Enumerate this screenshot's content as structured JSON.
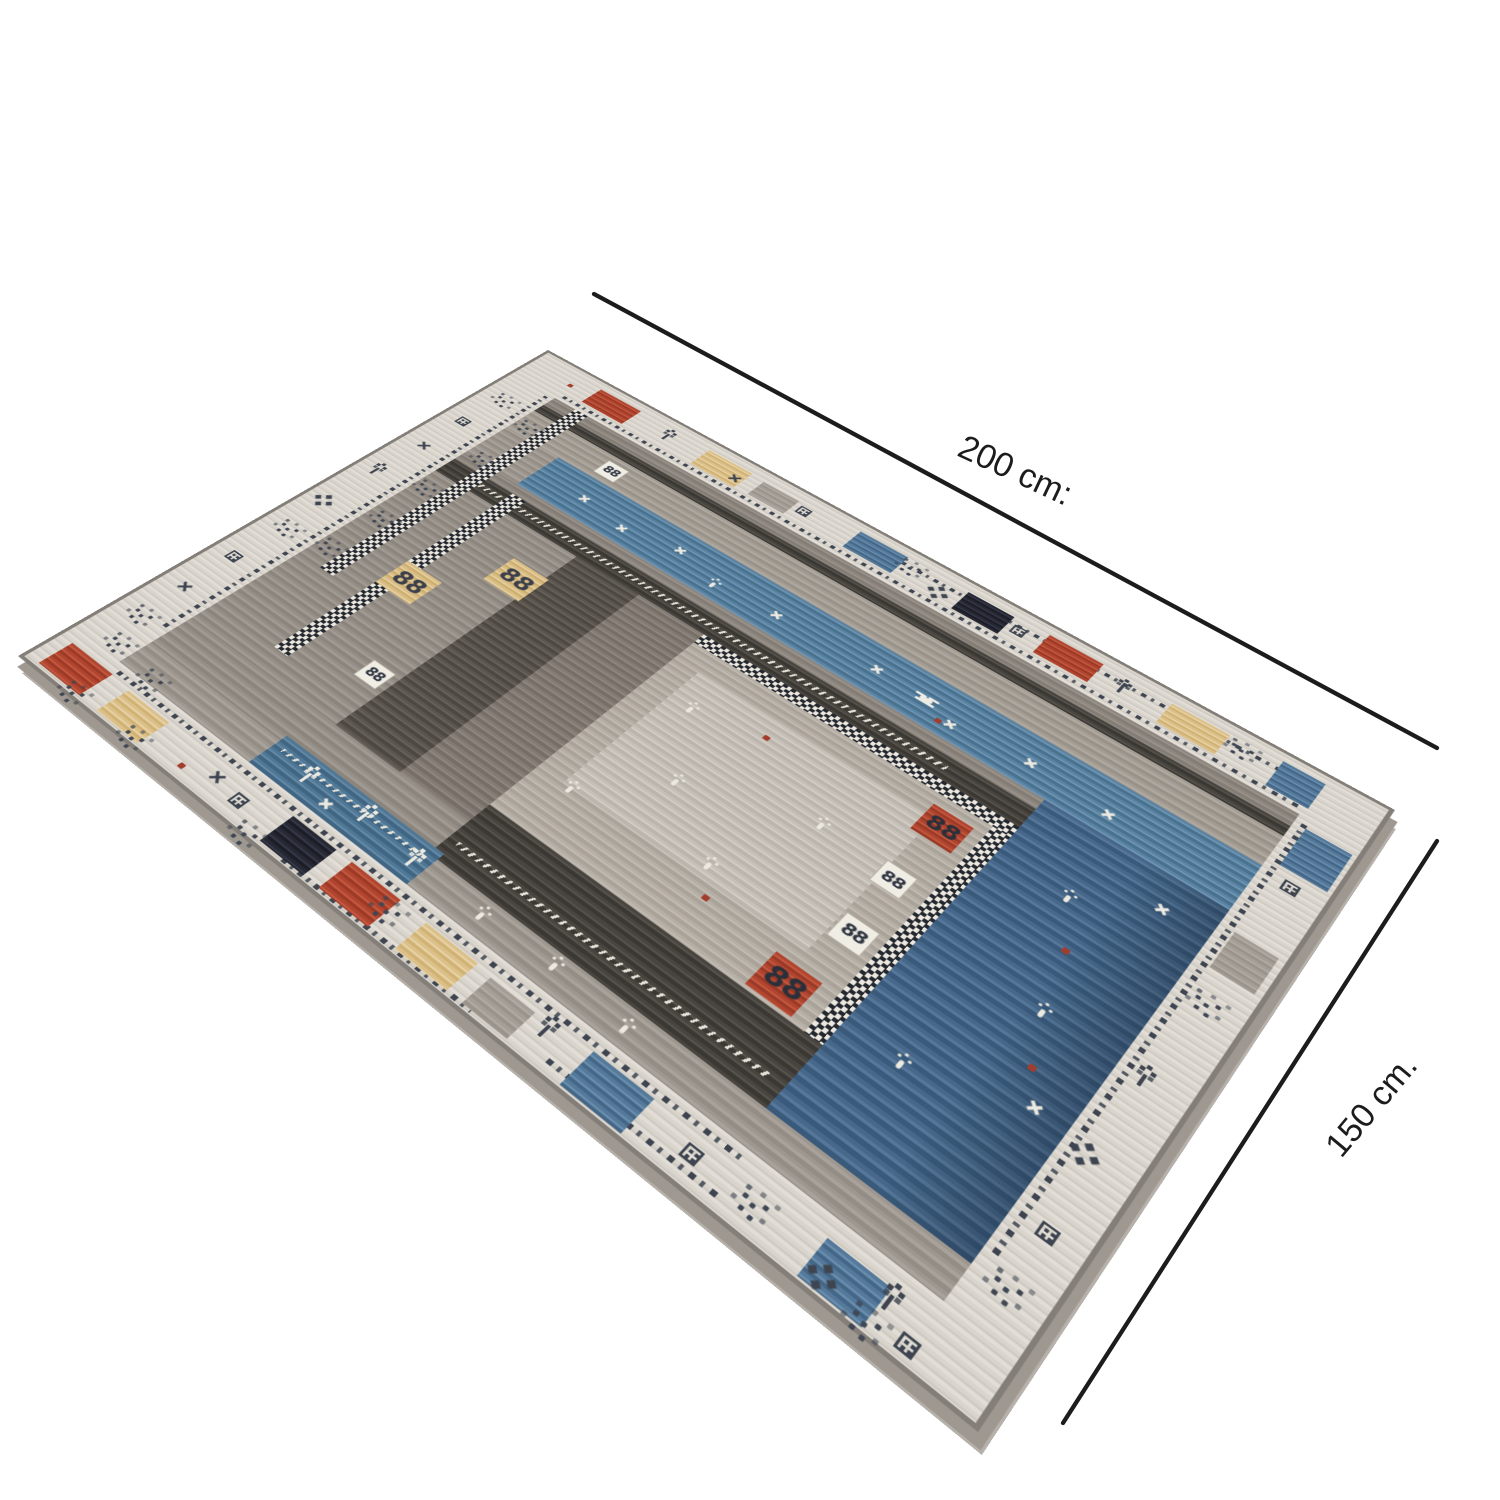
{
  "scene": {
    "type": "product-photo",
    "subject": "Gabbeh-style patterned area rug photographed at an angle on a white background",
    "background_color": "#ffffff"
  },
  "annotations": {
    "width_label": "200 cm:",
    "depth_label": "150 cm."
  },
  "rug_palette": {
    "background": "#ffffff",
    "dimension_line": "#1c1c1c",
    "border_cream": "#d9d5cd",
    "field_gray": "#9a948c",
    "charcoal": "#49453f",
    "panel_taupe": "#b8b1a8",
    "steel_blue": "#5d85a5",
    "slate_blue": "#4a6a8b",
    "accent_red": "#b2452f",
    "accent_beige": "#dcc08a",
    "accent_navy": "#262833",
    "motif_dark": "#3e4550",
    "motif_white": "#ece9e0"
  }
}
